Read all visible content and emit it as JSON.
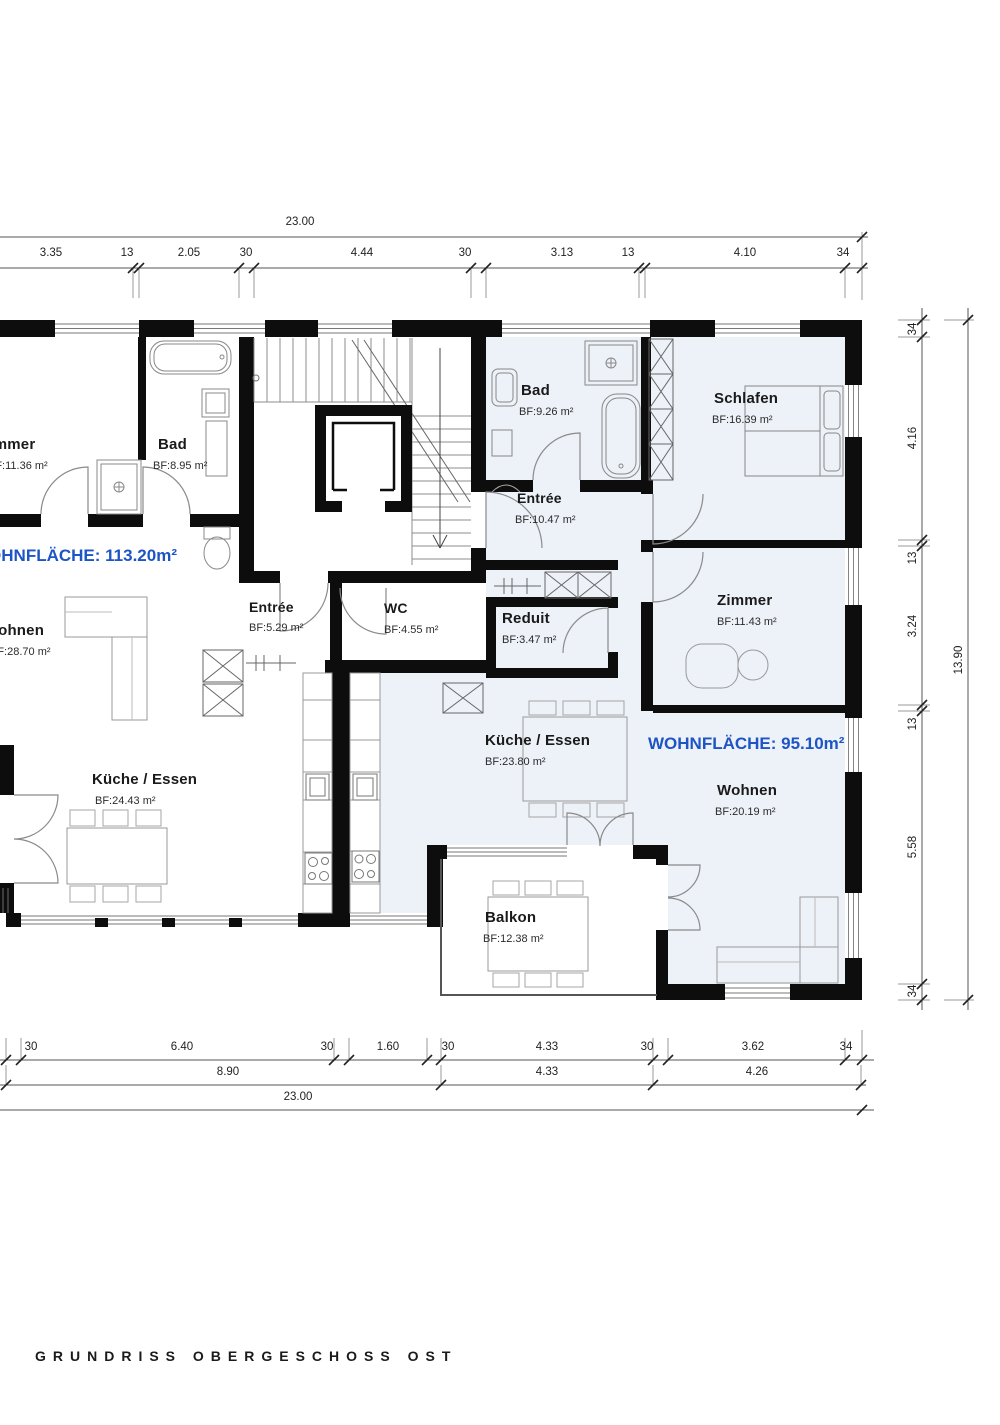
{
  "title": "GRUNDRISS OBERGESCHOSS OST",
  "apartments": {
    "left": {
      "wohnflaeche": "WOHNFLÄCHE: 113.20m²"
    },
    "right": {
      "wohnflaeche": "WOHNFLÄCHE: 95.10m²"
    }
  },
  "rooms": {
    "zimmer_left": {
      "name": "Zimmer",
      "area": "BF:11.36  m²"
    },
    "bad_left": {
      "name": "Bad",
      "area": "BF:8.95  m²"
    },
    "wohnen_left": {
      "name": "Wohnen",
      "area": "BF:28.70  m²"
    },
    "kueche_left": {
      "name": "Küche / Essen",
      "area": "BF:24.43  m²"
    },
    "entree_left": {
      "name": "Entrée",
      "area": "BF:5.29  m²"
    },
    "wc": {
      "name": "WC",
      "area": "BF:4.55  m²"
    },
    "bad_right": {
      "name": "Bad",
      "area": "BF:9.26  m²"
    },
    "schlafen": {
      "name": "Schlafen",
      "area": "BF:16.39  m²"
    },
    "entree_right": {
      "name": "Entrée",
      "area": "BF:10.47  m²"
    },
    "reduit": {
      "name": "Reduit",
      "area": "BF:3.47  m²"
    },
    "zimmer_right": {
      "name": "Zimmer",
      "area": "BF:11.43  m²"
    },
    "kueche_right": {
      "name": "Küche / Essen",
      "area": "BF:23.80  m²"
    },
    "wohnen_right": {
      "name": "Wohnen",
      "area": "BF:20.19  m²"
    },
    "balkon": {
      "name": "Balkon",
      "area": "BF:12.38  m²"
    }
  },
  "dimensions": {
    "top": {
      "total": "23.00",
      "segments": [
        "3.35",
        "13",
        "2.05",
        "30",
        "4.44",
        "30",
        "3.13",
        "13",
        "4.10",
        "34"
      ]
    },
    "right": {
      "total": "13.90",
      "segments": [
        "34",
        "4.16",
        "13",
        "3.24",
        "13",
        "5.58",
        "34"
      ]
    },
    "bottom": {
      "row1": [
        "30",
        "6.40",
        "30",
        "1.60",
        "30",
        "4.33",
        "30",
        "3.62",
        "34"
      ],
      "row2": [
        "8.90",
        "4.33",
        "4.26"
      ],
      "total": "23.00"
    }
  },
  "colors": {
    "accent_blue": "#1d55c4",
    "wall": "#0d0d0d",
    "apartment_tint": "#edf1f8"
  }
}
